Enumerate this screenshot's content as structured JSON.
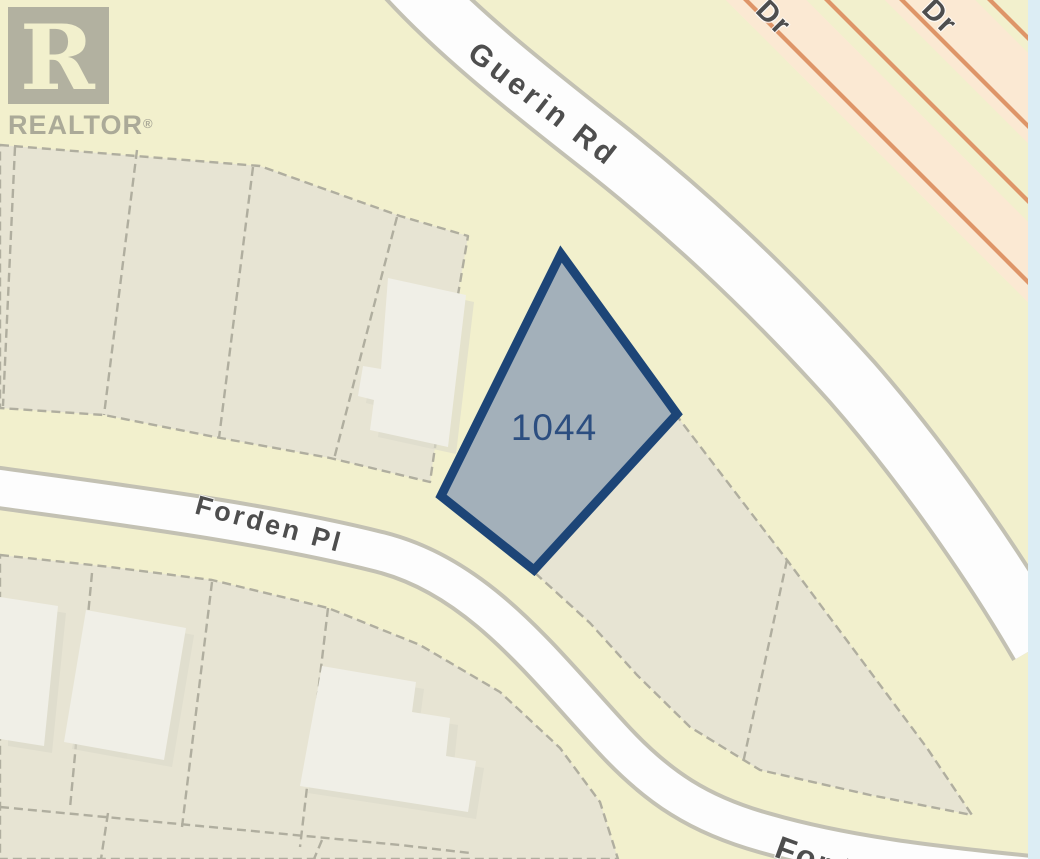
{
  "map": {
    "watermark": {
      "symbol": "R",
      "brand": "REALTOR",
      "registered_mark": "®"
    },
    "highlighted_parcel": {
      "number": "1044"
    },
    "road_labels": {
      "guerin": "Guerin Rd",
      "forden": "Forden Pl",
      "forden_truncated": "Ford",
      "dr_west": "Dr",
      "dr_east": "Dr"
    },
    "colors": {
      "background": "#f2f0cd",
      "parcel_block_fill": "#e7e4d3",
      "parcel_boundary_dash": "#b0ae9f",
      "building_fill": "#f0efe7",
      "building_shadow": "#dcdacb",
      "local_road_fill": "#fdfdfd",
      "local_road_casing": "#c3c1b3",
      "major_road_fill": "#fbe9d3",
      "major_road_casing": "#de9568",
      "water_strip": "#dcedf4",
      "highlight_outline": "#1d4577",
      "highlight_fill": "#a3b0ba",
      "highlight_label": "#2c4e80",
      "road_label": "#4e4e4e",
      "watermark_gray": "#a3a295"
    }
  }
}
